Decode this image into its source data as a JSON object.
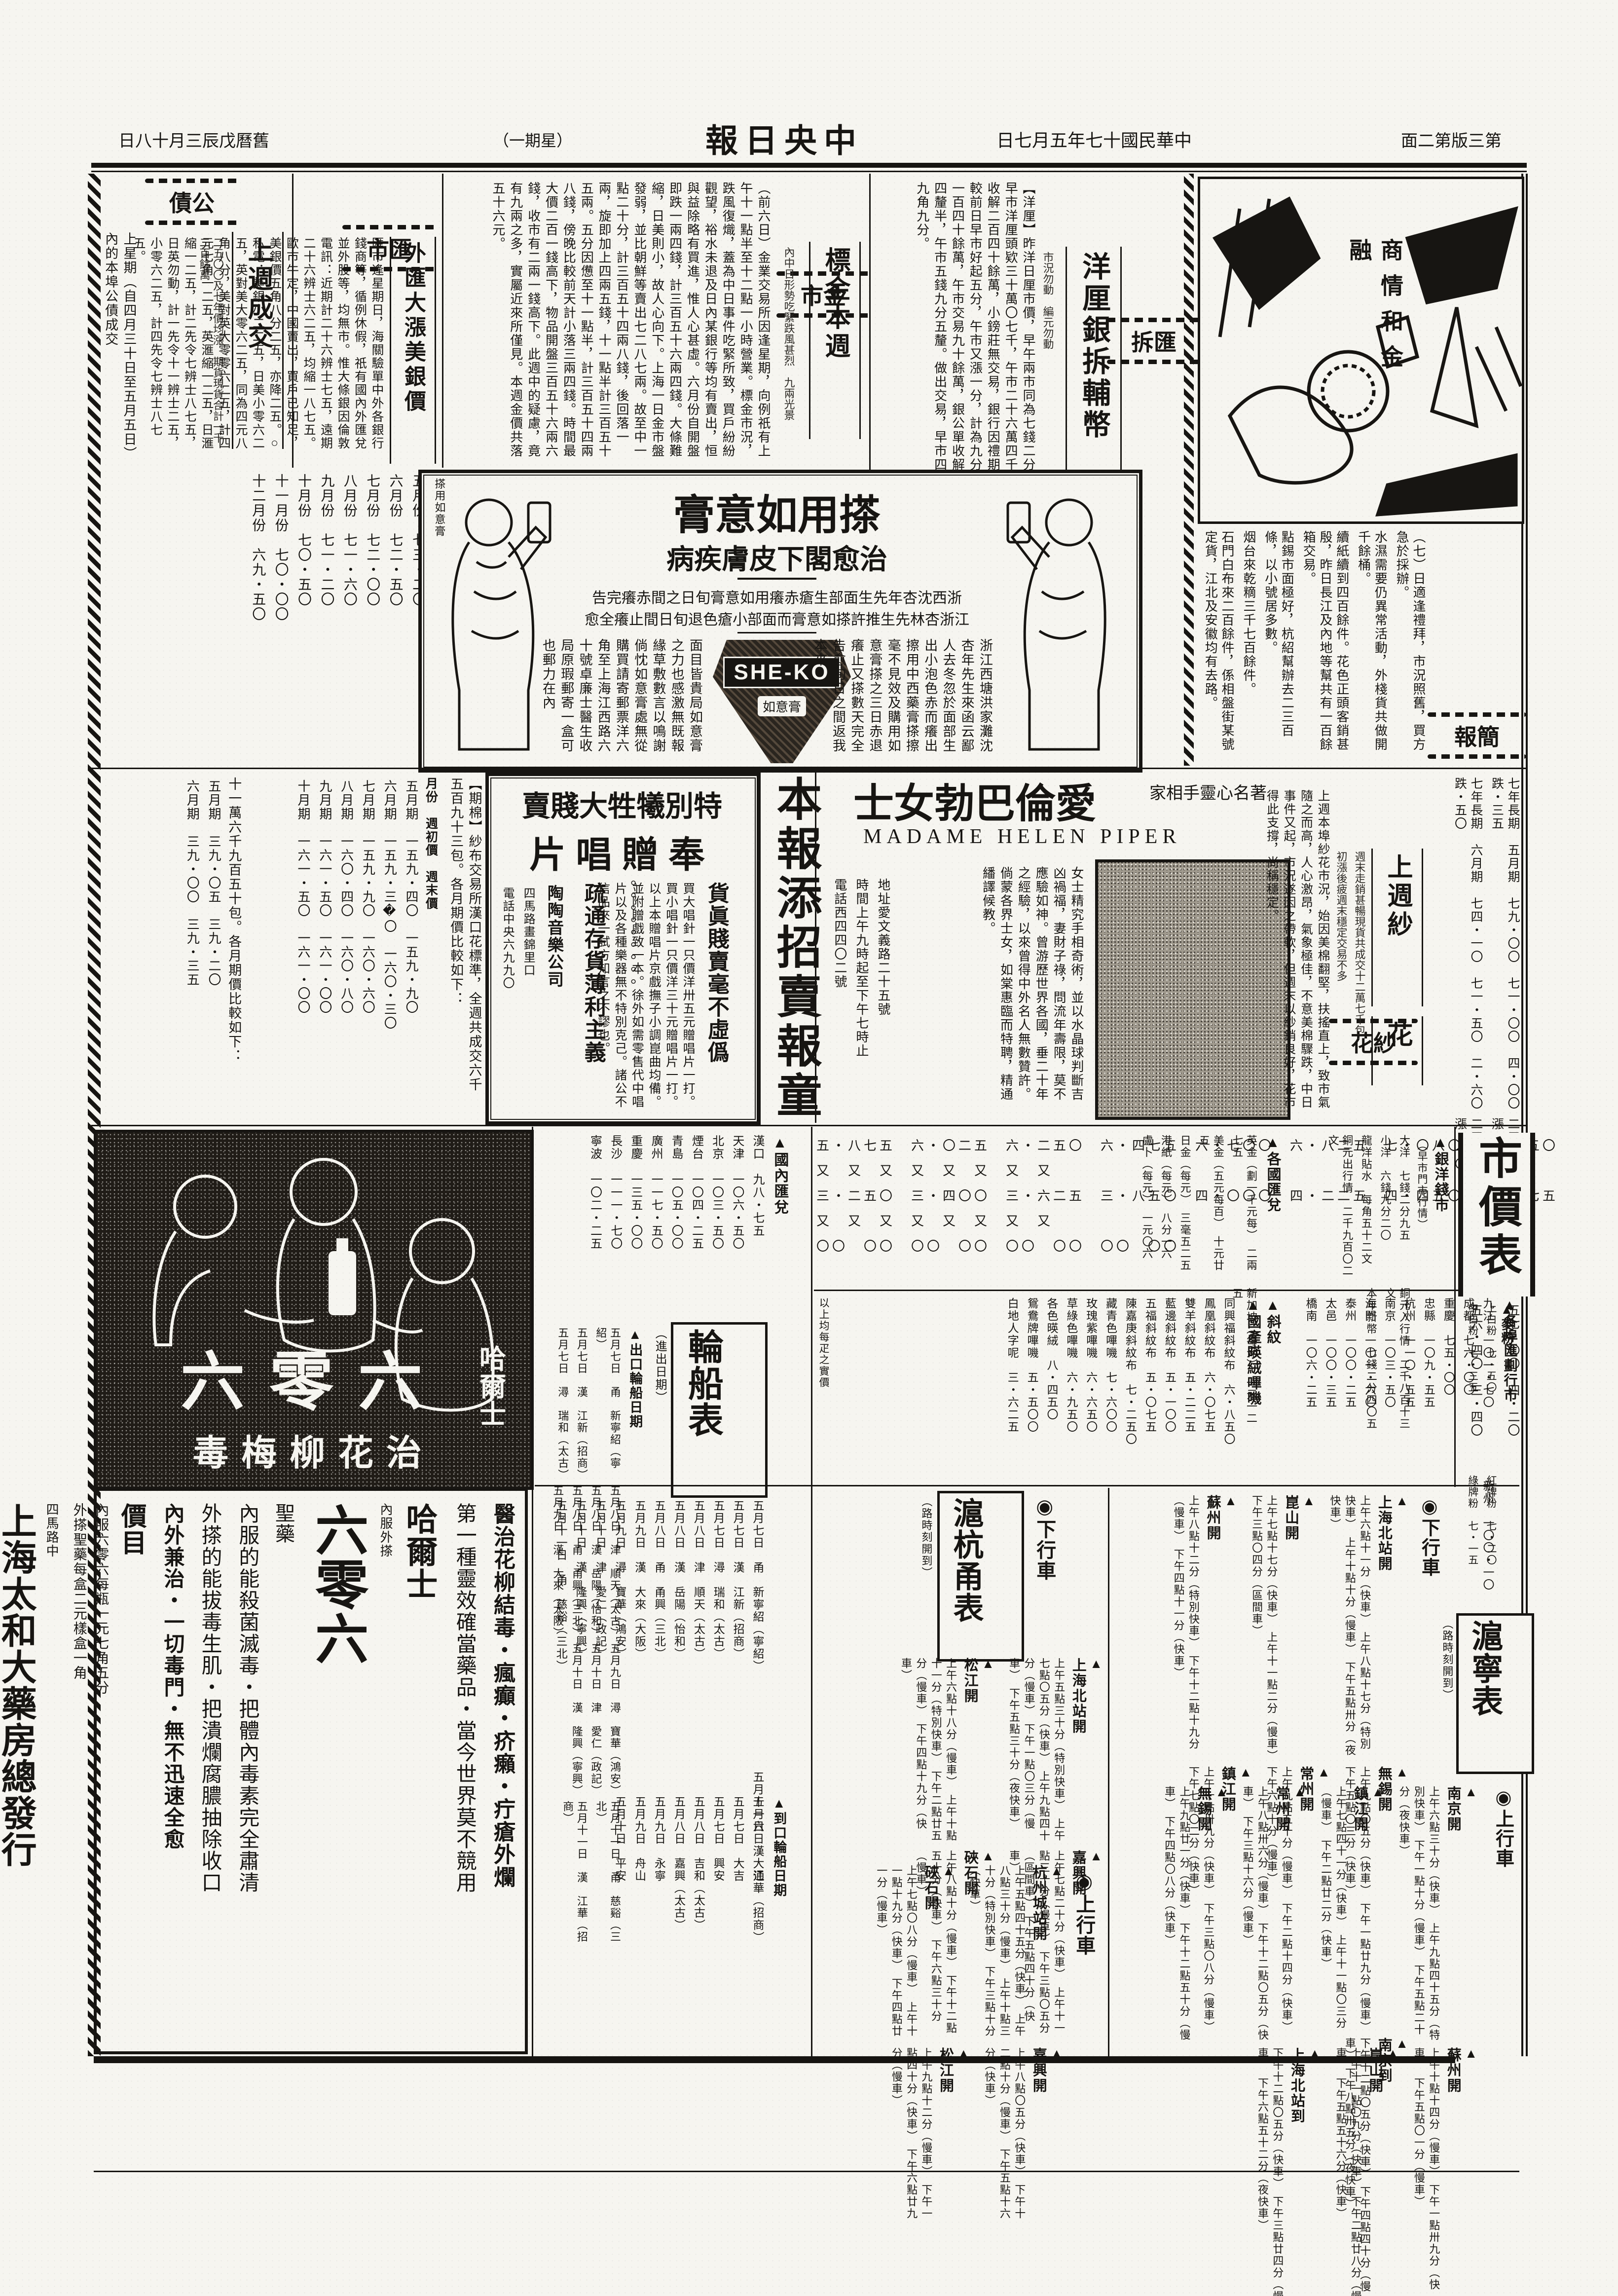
{
  "masthead": {
    "edition": "第三版第二面",
    "date": "中華民國十七年五月七日",
    "title": "中央日報",
    "weekday": "（星期一）",
    "lunar": "舊曆戊辰三月十八日"
  },
  "cartoon": {
    "caption": "商情和金融"
  },
  "jianbao": {
    "header": "簡報",
    "items": [
      "（七）日適逢禮拜，市況照舊，買方急於採辦。",
      "水濕需要仍異常活動，外棧貨共做開千餘桶。",
      "續紙續到四百餘件。花色正頭客銷甚殷，昨日長江及內地等幫共有一百餘箱交易。",
      "點錫市面極好，杭紹幫辦去二三百條，以小號居多數。",
      "烟台來乾䊞三千七百餘件。",
      "石門白布來二百餘件，係相盤街某號定貨，江北及安徽均有去路。"
    ]
  },
  "huichai": {
    "header": "匯拆",
    "headline": "洋厘銀拆輔幣",
    "subnote": "市況勿動　編元勿動",
    "body": "【洋厘】昨洋日厘市價，早午兩市同為七錢二分五釐二毫半，較前日改高二毫半。做出交易：早市洋厘頭欵三十萬〇七千，午市二十六萬四千；鈔票早市二萬五千，午市一萬五千；洋公單收解二百四十餘萬，小鎊莊無交易，銀行因禮期亦無成交。【銀拆】早市轉帳行情，祇做八分，較前日早市好起五分，午市又漲一分，計為九分。鈔票交易，早市轉帳四百九十餘萬，現交易一百四十餘萬，午市交易九十餘萬，銀公單收解二千二百餘萬。【輔洋】早市四開做關五錢九分四釐半，午市五錢九分五釐。做出交易，早市四萬五千角，午市四萬五千角，半市一千二百十九角九分。"
  },
  "jinshi": {
    "header": "金市",
    "headline": "標金本週",
    "subnote": "內中日形勢吃緊跌風甚烈　九兩光景",
    "body": "（前六日）金業交易所因逢星期，向例祇有上午十一點半至十二點一小時營業。標金市況，跌風復熾，蓋為中日事件吃緊所致，買戶紛紛觀望，裕水未退及日內某銀行等均有賣出，恒與益除略有買進，惟人心甚虛。六月份自開盤即跌一兩四錢，計三百五十六兩四錢。大條難縮，日美則小，故人心向下。上海一日金市盤發弱，並比朝鮮等賣出七二八七兩。故至中一點二十分，計三百五十四兩八錢，後回落一兩，旋即加上四兩五錢，十一點半計三百五十五兩。五分因憊至十一點半，計三百五十四兩八錢，傍晚比較前天計小落三兩四錢。時間最大價二百一錢高下，物品開盤三百五十六兩六錢，收市有二兩一錢高下。此週中的疑慮，竟有九兩之多，實屬近來所僅見。本週金價共落五十六元。"
  },
  "huishi": {
    "header": "匯市",
    "headline": "外匯大漲美銀價",
    "subnote": "二五",
    "body": "匯市逢星期日，海關驗單中外各銀行錢商等，循例休假，祇有國內外匯兌並外股等，均無市。惟大條銀因倫敦電訊：近期計二十六辨士七五，遠期二十六辨士六二五，均縮一八七五。歐市牛定，中國賣出，買戶已知足，美銀價五角八分二五，亦降二五。○私電：美銀小二二五，日美小零六二五，英對美大零六二五，同為四元八角八分，美對英大零零六二五，計四元七角一二五，英滙縮一二五，日滙縮一二五，計二先令七辨士八七五，日英勿動，計一先令十一辨士二五，小零六二五，計四先令七辨士八七五。"
  },
  "gongzhai": {
    "header": "公債",
    "headline": "上週成交",
    "subnote": "二五〇〇及七年價均漲　期貨現貨合計一千二百餘萬",
    "left_note": "上星期（自四月三十日至五月五日）內的本埠公債成交",
    "months_label": "各月份期價",
    "months": [
      "五月份　七三・二〇",
      "六月份　七二・五〇",
      "七月份　七二・〇〇",
      "八月份　七一・六〇",
      "九月份　七一・二〇",
      "十月份　七〇・五〇",
      "十一月份　七〇・〇〇",
      "十二月份　六九・五〇"
    ]
  },
  "sheko": {
    "title": "搽用如意膏",
    "subtitle": "治愈閣下皮膚疾病",
    "par1": "浙西沈杏年先生面部生瘡赤癢用如意膏旬日之間赤癢完告",
    "par2": "江浙杏林先生推許搽如意膏而面部小瘡色退旬日間止癢全愈",
    "right_col": "浙江西塘洪家灘沈杏年先生來函云鄙人去冬忽於面部生出小泡色赤而癢出擦用中西藥膏搽擦毫不見效及購用如意膏搽之三日赤退癢止又搽數天完全告愈旬日之間返我本來",
    "left_col": "面目皆貴局如意膏之力也感激無既報緣草敷數言以鳴謝倘忱如意膏處無從購買請寄郵票洋六角至上海江西路六十號卓廉士醫生收局原瑕郵寄一盒可也郵力在內",
    "brand": "SHE-KO",
    "tin_label": "如意膏",
    "corner_stamp": "搽用如意膏"
  },
  "qimian": {
    "intro1": "【期棉】紗布交易所漢口花標準，全週共成交六千五百九十三包。各月期價比較如下：",
    "cols_label": "月份　週初價　週末價",
    "table1": [
      "五月期　一五九・四〇　一五九・九〇",
      "六月期　一五九・三�〇　一六〇・三〇",
      "七月期　一五九・九〇　一六〇・六〇",
      "八月期　一六〇・四〇　一六〇・八〇",
      "九月期　一六一・五〇　一六一・〇〇",
      "十月期　一六一・五〇　一六一・〇〇"
    ],
    "intro2": "十一萬六千九百五十包。各月期價比較如下：",
    "table2": [
      "五月期　三九・〇五　三九・二〇",
      "六月期　三九・〇〇　三九・三五"
    ]
  },
  "record_ad": {
    "title": "特別犧牲大賤賣",
    "title2": "奉贈唱片",
    "slogan1": "貨眞賤賣毫不虛僞",
    "slogan2": "疏通存貨薄利主義",
    "dots": "。。。。。。。。。",
    "body": "買大唱針一只價洋卅五元贈唱片一打。買小唱針一只價洋三十元贈唱片一打。以上本贈唱片京戲撫子小調崑曲均備。並附贈戲致一本。徐外如需零售代中唱片以及各種樂器無不特別克己。諸公不信品來一試方知言之不謬也。",
    "firm": "陶陶音樂公司",
    "addr": "四馬路畫錦里口",
    "tel": "電話中央六九九〇"
  },
  "newsboy": {
    "title": "本報添招賣報童",
    "note1": "本報因擴大宣傳起見，擬添招賣報童數名，如有身家清白，",
    "note2": "具有確實保證人者，可向本社發行股接洽。"
  },
  "piper": {
    "tagline": "著名心靈手相家",
    "title": "愛倫巴勃女士",
    "latin": "MADAME  HELEN  PIPER",
    "body": "女士精究手相奇術，並以水晶球判斷吉凶禍福，妻財子祿，問流年壽限，莫不應驗如神。曾游歷世界各國，垂二十年之經驗，以來曾得中外名人無數贊許。倘蒙各界士女，如棠惠臨而特聘，精通繙譯候教。",
    "addr": "地址愛文義路二十五號",
    "hours": "時間上午九時起至下午七時止",
    "tel": "電話西四四〇二號"
  },
  "shahua": {
    "header": "紗花",
    "headline": "上週紗",
    "note1": "週末走銷甚暢現貨共成交十二萬七千包",
    "headline2": "花",
    "note2": "初漲後疲週末穩定交易不多",
    "body": "上週本埠紗花市況，始因美棉翻堅，扶搖直上，致市氣隨之而高，人心激昂，氣象極佳，不意美棉驟跌，中日事件又起，市況遂因之帶軟，但週末以紗銷良好，花市得此支撐，尚稱穩定。",
    "bonds": [
      "七年長期　五月期　七九・〇〇　七一・〇〇　四・〇〇　跌・三五",
      "七年長期　六月期　七四・一〇　七一・五〇　二・六〇　跌・五〇",
      "二五大票　現貨　六一・二〇　五七・〇〇　四・二〇　漲・四〇",
      "二五小票　現貨　五九・八〇　五六・四〇　三・四〇　漲・一〇"
    ]
  },
  "ad606": {
    "big": "六零六",
    "side": "哈爾士",
    "bottom": "治花柳梅毒"
  },
  "taiho": {
    "line1": "醫治花柳結毒・瘋癲・疥癩・疔瘡外爛",
    "line2": "第一種靈效確當藥品・當今世界莫不競用",
    "brand": "哈爾士",
    "brand_note": "內服外搽",
    "brand_big": "六零六",
    "brand_tail": "聖藥",
    "line3": "內服的能殺菌滅毒・把體內毒素完全肅清",
    "line4": "外搽的能拔毒生肌・把潰爛腐膿抽除收口",
    "line5": "內外兼治・一切毒門・無不迅速全愈",
    "price_label": "價目",
    "price1": "內服六零六每瓶一元七角五分",
    "price2": "外搽聖藥每盒二元樣盒一角",
    "firm": "上海太和大藥房總發行",
    "firm_note1": "四馬路中",
    "firm_note2": "各埠藥房均有出售"
  },
  "guonei": {
    "header": "▲國內匯兌",
    "items": [
      "漢口　九八・七五",
      "天津　一〇六・五〇",
      "北京　一〇三・五〇",
      "煙台　一〇四・二五",
      "青島　一〇五・〇〇",
      "廣州　一一七・五〇",
      "重慶　一三五・〇〇",
      "長沙　一一一・七〇",
      "寧波　一〇二・二五"
    ]
  },
  "ships": {
    "header": "輪船表",
    "note": "（進出日期）",
    "out_label": "▲出口輪船日期",
    "out_items": [
      "五月七日　甬　新寧紹（寧紹）",
      "五月七日　漢　江新（招商）",
      "五月七日　潯　瑞和（太古）",
      "五月八日　津　順天（太古）",
      "五月八日　漢　岳陽（怡和）",
      "五月八日　甬　甬興（三北）",
      "五月九日　漢　大來（大阪）",
      "五月九日　潯　寶華（鴻安）",
      "五月十日　津　愛仁（政記）",
      "五月十日　漢　隆興（寧興）",
      "五月十一日　甬　慈谿（三北）",
      "五月十一日　漢　江華（招商）"
    ],
    "in_label": "▲到口輪船日期",
    "in_items": [
      "五月六日　大通",
      "五月七日　大吉",
      "五月七日　興安",
      "五月八日　吉和（太古）",
      "五月八日　嘉興（太古）",
      "五月九日　永寧",
      "五月九日　舟山",
      "五月十日　平安"
    ]
  },
  "commodities": {
    "rate_rows": [
      "五・八七五　六・〇二五　六・二五〇　六・四七五　六・七〇〇　六・八二五　七・〇八〇　七・二五〇",
      "又　又　又　又　又　又　又　又",
      "三・二五〇　三・四〇〇　三・六二五　三・八五〇　四・〇〇〇　四・二二五　四・四五〇　四・六七五",
      "又　又　又　又　又　又　又　又",
      "〇〇　〇〇　〇〇　〇〇　〇〇　〇〇　〇〇　〇〇"
    ],
    "silver_header": "▲銀洋錢市",
    "silver_note": "（早市門市行情）",
    "silver_items": [
      "大洋　七錢二分九五",
      "小洋　六錢九分二〇",
      "龍洋貼水　每角五十二文",
      "銅元出行情　二千九百〇二文",
      "銅元入行情　二千八百十三文",
      "本年新幣　七錢二分四〇五"
    ],
    "city_header": "▲各埠匯劃行市",
    "city_items": [
      "九江　一〇一・七〇",
      "成都　七六・〇〇",
      "重慶　七五・〇〇",
      "忠縣　一〇九・五五",
      "杭州　一一〇・五五",
      "南京　一〇三・五〇",
      "海門　一〇一・六〇",
      "泰州　一〇〇・二五",
      "太邑　一〇〇・三五",
      "橋南　一〇六・二五",
      "新州　一〇〇・一〇"
    ],
    "foreign_header": "▲各國匯兌",
    "foreign_items": [
      "英金（劃一千元每）　二兩七五",
      "美金（五元每百）　十元廿五",
      "日金（每元）　三毫五二五",
      "港紙（每元）　八分一六",
      "盧卜（每元）　一元〇六",
      "新加坡（每元）　一元一二五"
    ],
    "fabric_header1": "▲斜紋",
    "fabric_header2": "▲國產暎絨嗶嘰",
    "fabric_items": [
      "同興福斜紋布　六・八五〇",
      "鳳凰斜紋布　六・〇七五",
      "雙羊斜紋布　五・二二五",
      "藍邊斜紋布　五・一〇〇",
      "五福斜紋布　五・〇七五",
      "陳嘉庚斜紋布　七・二五〇",
      "藏青色嗶嘰　七・六〇〇",
      "玫瑰紫嗶嘰　六・六五〇",
      "草綠色嗶嘰　六・九五〇",
      "各色暎絨　八・四五〇",
      "鴛鴦牌嗶嘰　五・五〇〇",
      "白地人字呢　三・六二五"
    ],
    "fabric_note1": "以上均每疋之實價",
    "fabric_note2": "▲以上均嘜裝之定價"
  },
  "shanghang": {
    "header": "滬杭甬表",
    "note": "（路時刻開到）",
    "down_label": "◉下行車",
    "up_label": "◉上行車",
    "down": [
      {
        "name": "上海北站開",
        "times": "上午五點三十分（特別快車）　上午七點〇五分（快車）　上午九點四十分（慢車）　下午一點〇三分（慢車）　下午五點三十分（夜快車）"
      },
      {
        "name": "松江開",
        "times": "上午六點十八分（慢車）　上午十點十一分（特別快車）　下午二點廿五分（慢車）　下午四點十九分（快車）"
      },
      {
        "name": "嘉興開",
        "times": "上午七點二十分（快車）　上午十一點三十分（慢車）　下午三點〇五分（區間車）　下午五點四十分（快車）"
      },
      {
        "name": "硤石開",
        "times": "上午八點十分（慢車）　下午十二點五十分（快車）　下午六點三十分（慢車）"
      }
    ],
    "up": [
      {
        "name": "杭州城站開",
        "times": "上午五點四十五分（快車）　上午八點三十分（慢車）　上午十點三十分（特別快車）　下午三點十分（快車）"
      },
      {
        "name": "硤石開",
        "times": "上午七點〇八分（慢車）　上午十一點十九分（快車）　下午四點廿一分（慢車）"
      },
      {
        "name": "嘉興開",
        "times": "上午八點〇五分（快車）　下午十二點十分（慢車）　下午五點十六分（快車）"
      },
      {
        "name": "松江開",
        "times": "上午九點十二分（慢車）　下午一點四十分（快車）　下午六點廿九分（慢車）"
      }
    ]
  },
  "huning": {
    "header": "滬寧表",
    "note": "（路時刻開到）",
    "down_label": "◉下行車",
    "up_label": "◉上行車",
    "down": [
      {
        "name": "上海北站開",
        "times": "上午六點十一分（快車）　上午八點十七分（特別快車）　上午十點十分（慢車）　下午五點卅分（夜快車）"
      },
      {
        "name": "崑山開",
        "times": "上午七點十七分（快車）　上午十一點二分（慢車）　下午三點〇四分（區間車）"
      },
      {
        "name": "蘇州開",
        "times": "上午八點十二分（特別快車）　下午十二點十九分（慢車）　下午四點十一分（快車）"
      },
      {
        "name": "無錫開",
        "times": "上午九點〇五分（快車）　下午一點廿九分（慢車）　下午五點〇三分（快車）"
      },
      {
        "name": "常州開",
        "times": "上午九點五十分（慢車）　下午二點十四分（快車）　下午六點十分（慢車）"
      },
      {
        "name": "鎮江開",
        "times": "上午十點卅九分（快車）　下午三點〇八分（慢車）　下午七點〇二分（快車）"
      },
      {
        "name": "南京到",
        "times": "下午十二點〇五分（快車）　下午四點四十分（慢車）　下午八點卅五分（夜快車）"
      }
    ],
    "up": [
      {
        "name": "南京開",
        "times": "上午六點三十分（快車）　上午九點四十五分（特別快車）　下午一點十分（慢車）　下午五點二十分（夜快車）"
      },
      {
        "name": "鎮江開",
        "times": "上午七點四十一分（快車）　上午十一點〇三分（慢車）　下午二點廿二分（快車）"
      },
      {
        "name": "常州開",
        "times": "上午八點卅六分（慢車）　下午十二點〇五分（快車）　下午三點十六分（慢車）"
      },
      {
        "name": "無錫開",
        "times": "上午九點廿一分（快車）　下午十二點五十分（慢車）　下午四點〇八分（快車）"
      },
      {
        "name": "蘇州開",
        "times": "上午十點十四分（慢車）　下午一點卅九分（快車）　下午五點〇一分（慢車）"
      },
      {
        "name": "崑山開",
        "times": "上午十一點〇九分（快車）　下午二點廿八分（慢車）　下午五點五十六分（快車）"
      },
      {
        "name": "上海北站到",
        "times": "下午十二點〇五分（快車）　下午三點廿四分（慢車）　下午六點五十二分（夜快車）"
      }
    ]
  },
  "price_table": {
    "header": "市價表",
    "flour_label": "▲麥粉",
    "flour_items": [
      "上白粉　七・五〇",
      "中白粉　七・三五",
      "紅牌粉　七・二〇",
      "綠牌粉　七・一五"
    ]
  }
}
